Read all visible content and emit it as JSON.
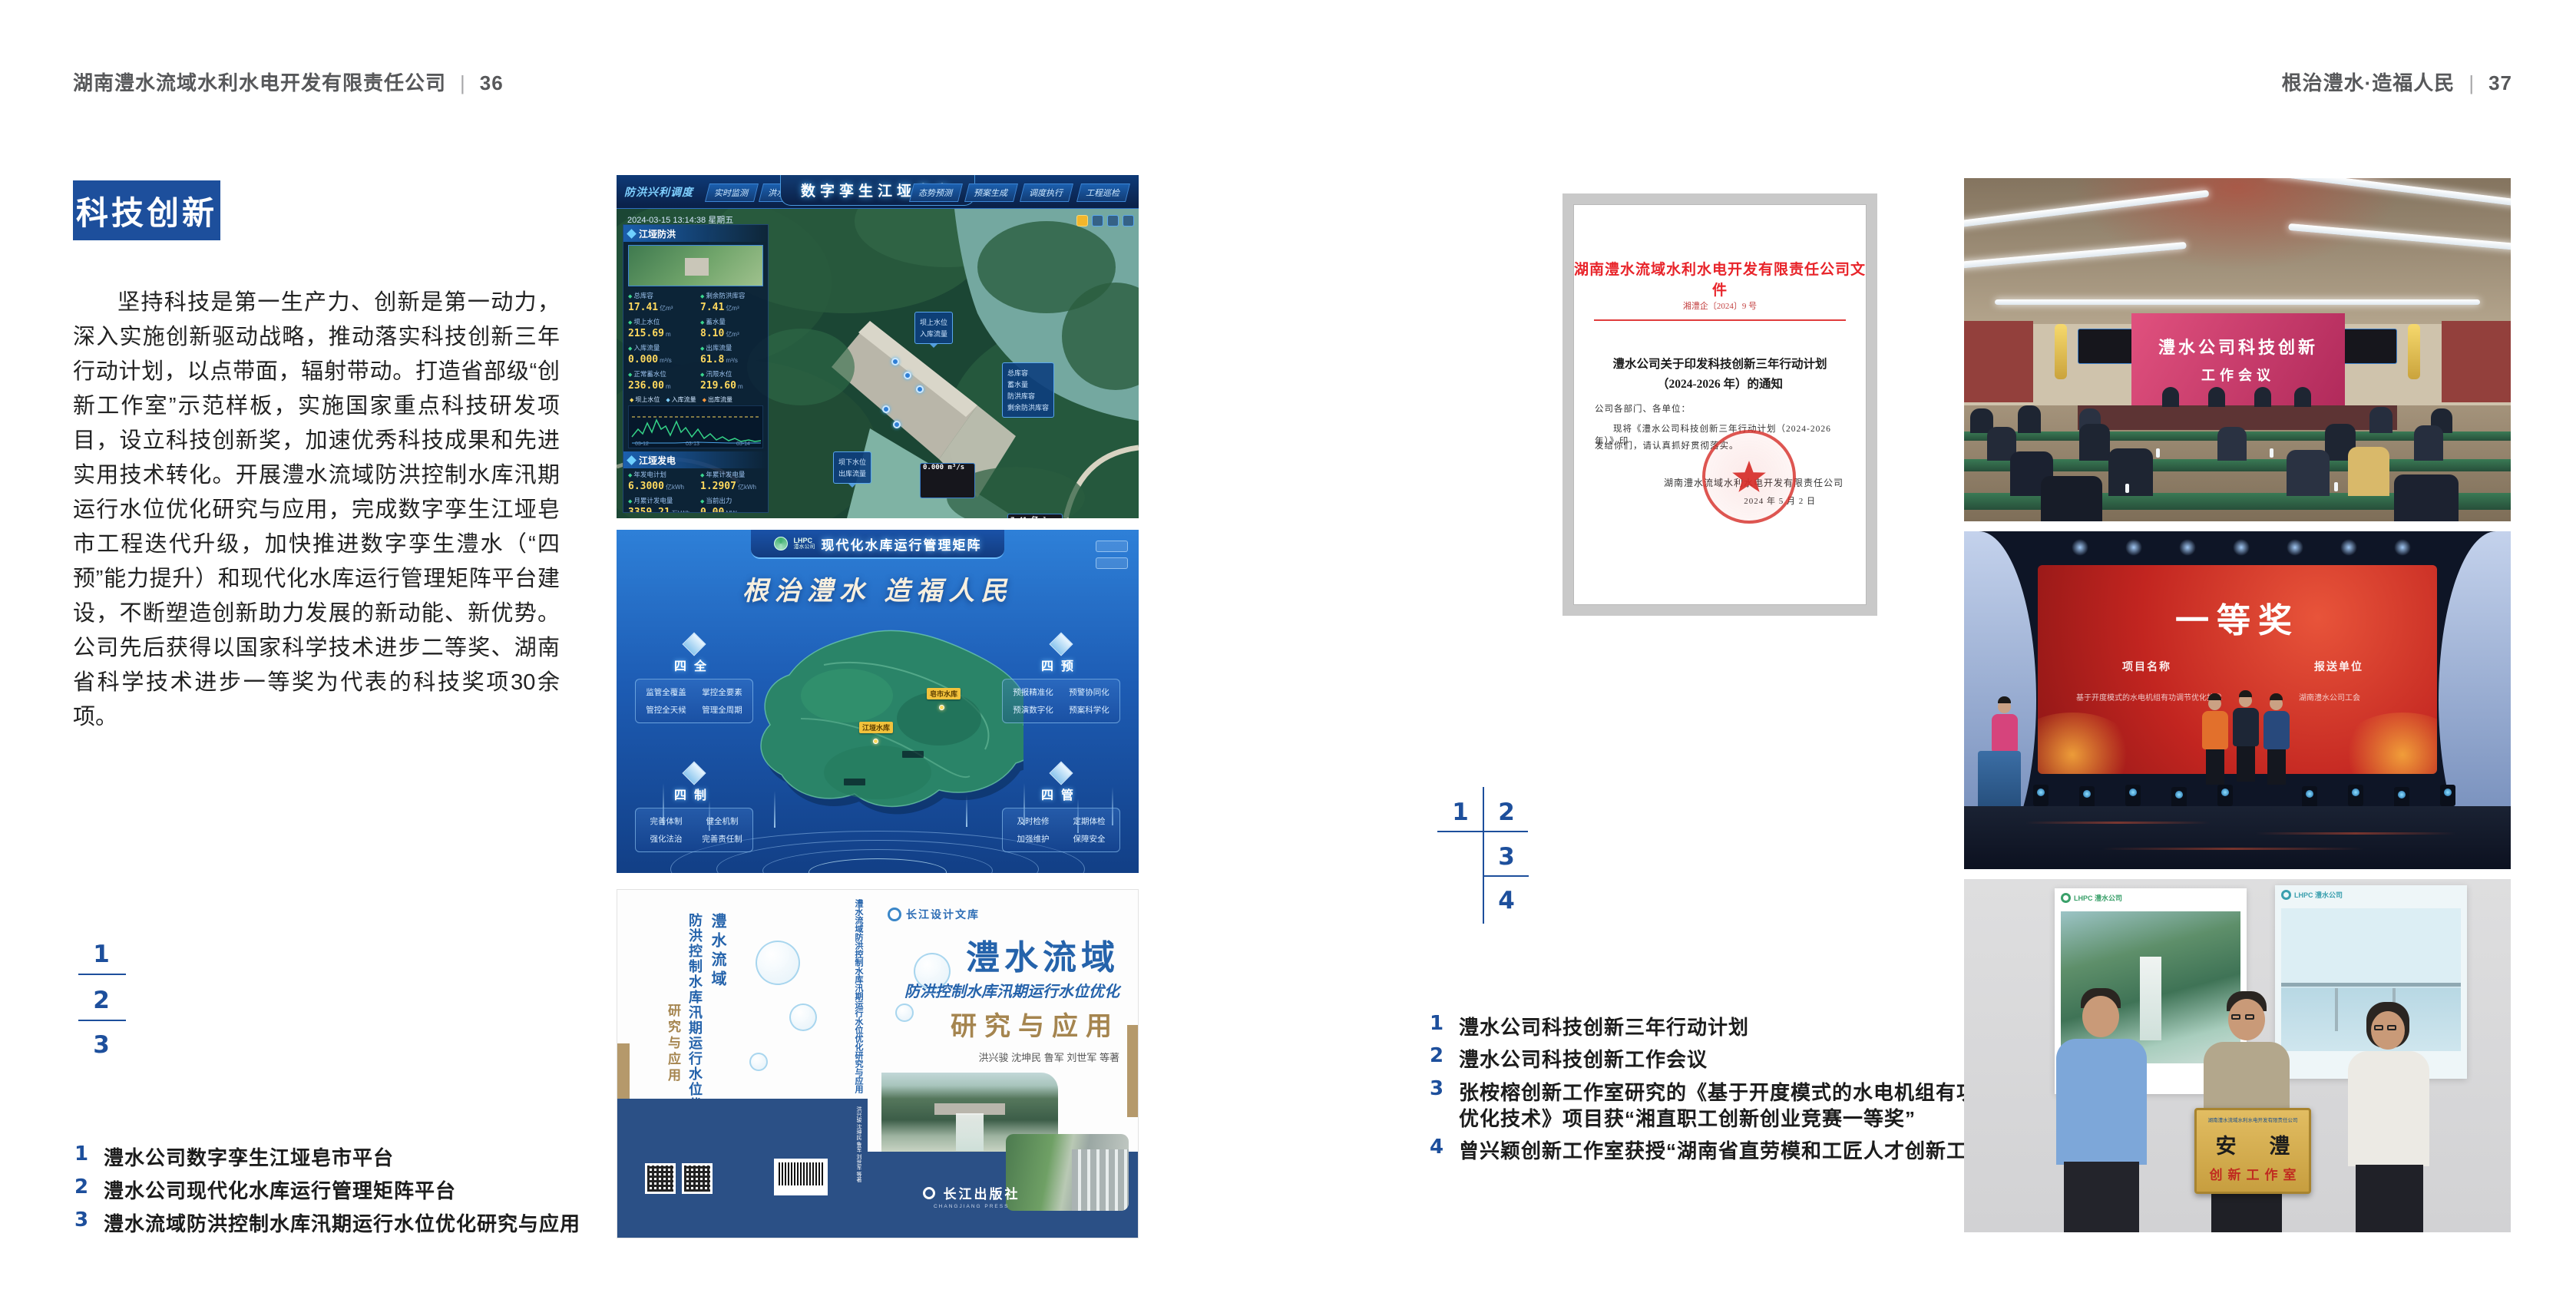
{
  "colors": {
    "accent_blue": "#1d4f9c",
    "navy_band": "#2b5086",
    "doc_red": "#e03c3c",
    "badge_bg": "#1d4f9c"
  },
  "page_left": {
    "header": {
      "company": "湖南澧水流域水利水电开发有限责任公司",
      "separator": "|",
      "page_number": "36"
    },
    "section_badge": "科技创新",
    "body_paragraph": "坚持科技是第一生产力、创新是第一动力，深入实施创新驱动战略，推动落实科技创新三年行动计划，以点带面，辐射带动。打造省部级“创新工作室”示范样板，实施国家重点科技研发项目，设立科技创新奖，加速优秀科技成果和先进实用技术转化。开展澧水流域防洪控制水库汛期运行水位优化研究与应用，完成数字孪生江垭皂市工程迭代升级，加快推进数字孪生澧水（“四预”能力提升）和现代化水库运行管理矩阵平台建设，不断塑造创新助力发展的新动能、新优势。公司先后获得以国家科学技术进步二等奖、湖南省科学技术进步一等奖为代表的科技奖项30余项。",
    "figure_markers": [
      "1",
      "2",
      "3"
    ],
    "captions": [
      {
        "num": "1",
        "text": "澧水公司数字孪生江垭皂市平台"
      },
      {
        "num": "2",
        "text": "澧水公司现代化水库运行管理矩阵平台"
      },
      {
        "num": "3",
        "text": "澧水流域防洪控制水库汛期运行水位优化研究与应用"
      }
    ]
  },
  "page_right": {
    "header": {
      "motto": "根治澧水·造福人民",
      "separator": "|",
      "page_number": "37"
    },
    "figure_markers": [
      "1",
      "2",
      "3",
      "4"
    ],
    "captions": [
      {
        "num": "1",
        "text": "澧水公司科技创新三年行动计划",
        "text2": ""
      },
      {
        "num": "2",
        "text": "澧水公司科技创新工作会议",
        "text2": ""
      },
      {
        "num": "3",
        "text": "张桉榕创新工作室研究的《基于开度模式的水电机组有功调节",
        "text2": "优化技术》项目获“湘直职工创新创业竞赛一等奖”"
      },
      {
        "num": "4",
        "text": "曾兴颖创新工作室获授“湖南省直劳模和工匠人才创新工作室”",
        "text2": ""
      }
    ]
  },
  "fig_dashboard": {
    "brand": "防洪兴利调度",
    "tabs_left": [
      "实时监测",
      "洪水预报",
      "防洪预警"
    ],
    "title": "数字孪生江垭皂市",
    "tabs_right": [
      "态势预测",
      "预案生成",
      "调度执行",
      "工程巡检"
    ],
    "timestamp": "2024-03-15 13:14:38 星期五",
    "panel_flood": {
      "title": "江垭防洪",
      "stats": [
        {
          "l": "总库容",
          "v": "17.41",
          "u": "亿m³"
        },
        {
          "l": "剩余防洪库容",
          "v": "7.41",
          "u": "亿m³"
        },
        {
          "l": "坝上水位",
          "v": "215.69",
          "u": "m"
        },
        {
          "l": "蓄水量",
          "v": "8.10",
          "u": "亿m³"
        },
        {
          "l": "入库流量",
          "v": "0.000",
          "u": "m³/s"
        },
        {
          "l": "出库流量",
          "v": "61.8",
          "u": "m³/s"
        },
        {
          "l": "正常蓄水位",
          "v": "236.00",
          "u": "m"
        },
        {
          "l": "汛限水位",
          "v": "219.60",
          "u": "m"
        }
      ],
      "legend": [
        "坝上水位",
        "入库流量",
        "出库流量"
      ],
      "chart_x": [
        "03-12",
        "03-13",
        "03-14"
      ]
    },
    "panel_power": {
      "title": "江垭发电",
      "stats": [
        {
          "l": "年发电计划",
          "v": "6.3000",
          "u": "亿kWh"
        },
        {
          "l": "年累计发电量",
          "v": "1.2907",
          "u": "亿kWh"
        },
        {
          "l": "月累计发电量",
          "v": "3359.21",
          "u": "万kWh"
        },
        {
          "l": "当前出力",
          "v": "0.00",
          "u": "MW"
        },
        {
          "l": "发电流量",
          "v": "0.00",
          "u": "m³/s"
        },
        {
          "l": "泄水流量",
          "v": "0.00",
          "u": "m³/s"
        }
      ]
    },
    "tag_up": {
      "rows": [
        {
          "l": "坝上水位",
          "v": "215.69 m"
        },
        {
          "l": "入库流量",
          "v": "0.000 m³/s"
        }
      ]
    },
    "tag_res": {
      "rows": [
        {
          "l": "总库容",
          "v": "17.41 亿m³"
        },
        {
          "l": "蓄水量",
          "v": "8.19 亿m³"
        },
        {
          "l": "防洪库容",
          "v": "7.41 亿m³"
        },
        {
          "l": "剩余防洪库容",
          "v": "7.41 亿m³"
        }
      ]
    },
    "tag_down": {
      "rows": [
        {
          "l": "坝下水位",
          "v": "108.19 m"
        },
        {
          "l": "出库流量",
          "v": "61.8 m³/s"
        }
      ]
    }
  },
  "fig_matrix": {
    "brand_abbr": "LHPC",
    "brand_name": "澧水公司",
    "title": "现代化水库运行管理矩阵",
    "slogan": "根治澧水 造福人民",
    "panels": [
      {
        "title": "四全",
        "items": [
          "监管全覆盖",
          "掌控全要素",
          "管控全天候",
          "管理全周期"
        ]
      },
      {
        "title": "四预",
        "items": [
          "预报精准化",
          "预警协同化",
          "预演数字化",
          "预案科学化"
        ]
      },
      {
        "title": "四制",
        "items": [
          "完善体制",
          "健全机制",
          "强化法治",
          "完善责任制"
        ]
      },
      {
        "title": "四管",
        "items": [
          "及时检修",
          "定期体检",
          "加强维护",
          "保障安全"
        ]
      }
    ],
    "markers": [
      "皂市水库",
      "江垭水库"
    ]
  },
  "fig_book": {
    "series": "长江设计文库",
    "title_main": "澧水流域",
    "title_sub": "防洪控制水库汛期运行水位优化",
    "title_tail": "研究与应用",
    "authors": "洪兴骏 沈坤民 鲁军 刘世军 等著",
    "publisher": "长江出版社",
    "publisher_en": "CHANGJIANG PRESS",
    "spine_title": "澧水流域防洪控制水库汛期运行水位优化研究与应用"
  },
  "fig_document": {
    "header": "湖南澧水流域水利水电开发有限责任公司文件",
    "doc_no": "湘澧企〔2024〕9 号",
    "title1": "澧水公司关于印发科技创新三年行动计划",
    "title2": "（2024-2026 年）的通知",
    "salutation": "公司各部门、各单位：",
    "body1": "现将《澧水公司科技创新三年行动计划（2024-2026 年）》印",
    "body2": "发给你们，请认真抓好贯彻落实。",
    "signer": "湖南澧水流域水利水电开发有限责任公司",
    "date": "2024 年 5 月 2 日"
  },
  "fig_meeting": {
    "screen1": "澧水公司科技创新",
    "screen2": "工作会议"
  },
  "fig_award": {
    "title": "一等奖",
    "col1": "项目名称",
    "col2": "报送单位",
    "item1": "基于开度模式的水电机组有功调节优化技术",
    "item2": "湖南澧水公司工会"
  },
  "fig_plaque": {
    "header": "湖南澧水流域水利水电开发有限责任公司",
    "name": "安 澧",
    "sub": "创新工作室",
    "poster_brand_abbr": "LHPC",
    "poster_brand_name": "澧水公司"
  }
}
